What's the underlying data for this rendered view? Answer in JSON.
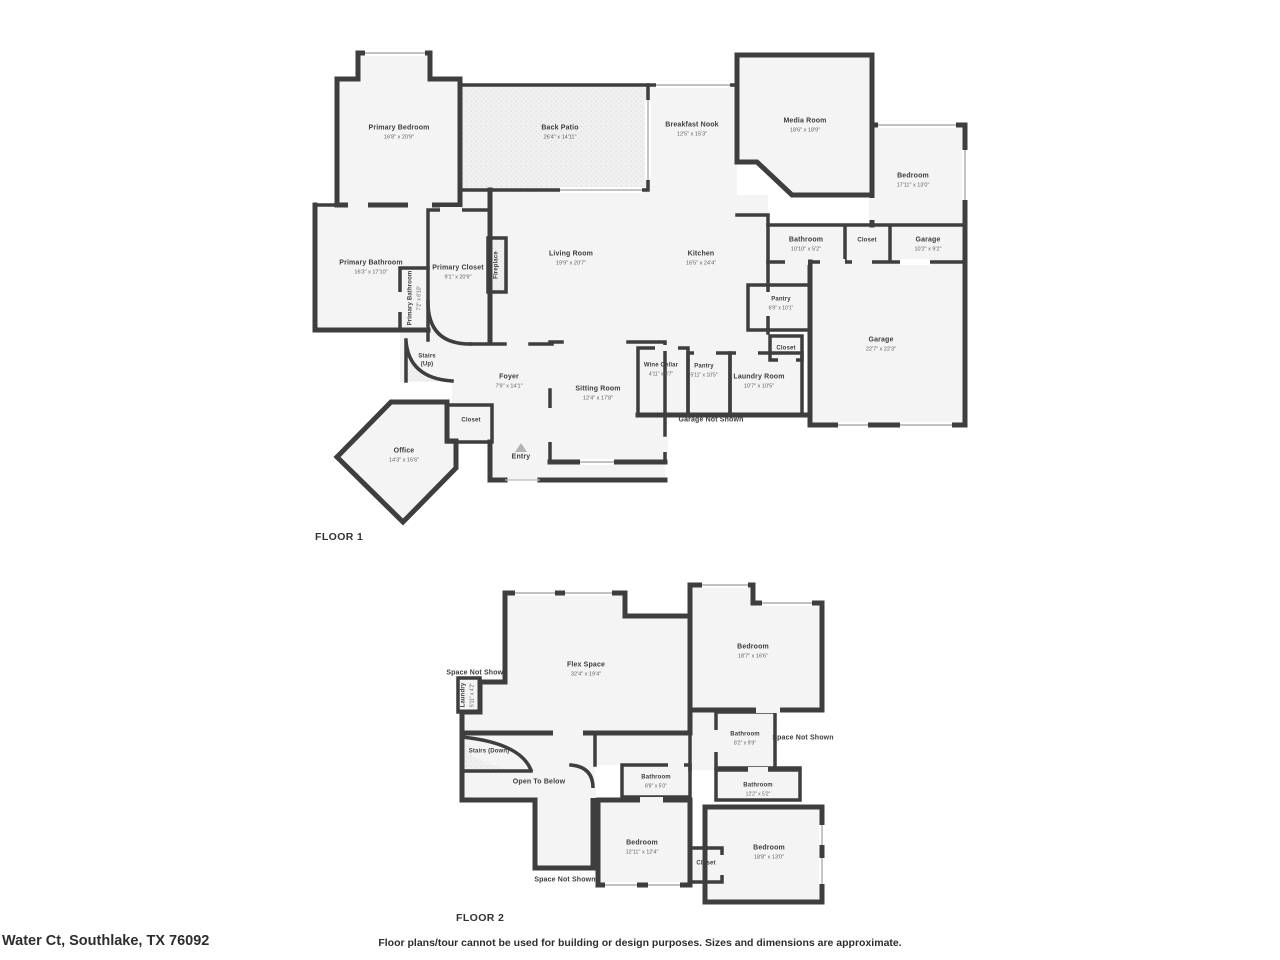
{
  "address": "Water Ct, Southlake, TX 76092",
  "disclaimer": "Floor plans/tour cannot be used for building or design purposes. Sizes and dimensions are approximate.",
  "colors": {
    "wall": "#3e3e3e",
    "room_fill": "#f4f4f4",
    "text": "#3d3d3d"
  },
  "floor1": {
    "title": "FLOOR 1",
    "rooms": {
      "primary_bedroom": {
        "name": "Primary Bedroom",
        "dims": "16'8\" x 20'9\""
      },
      "back_patio": {
        "name": "Back Patio",
        "dims": "26'4\" x 14'11\""
      },
      "breakfast_nook": {
        "name": "Breakfast Nook",
        "dims": "12'5\" x 15'3\""
      },
      "media_room": {
        "name": "Media Room",
        "dims": "18'6\" x 18'9\""
      },
      "bedroom": {
        "name": "Bedroom",
        "dims": "17'11\" x 13'0\""
      },
      "living_room": {
        "name": "Living Room",
        "dims": "19'9\" x 20'7\""
      },
      "kitchen": {
        "name": "Kitchen",
        "dims": "16'5\" x 24'4\""
      },
      "bathroom": {
        "name": "Bathroom",
        "dims": "10'10\" x 5'2\""
      },
      "closet_hall": {
        "name": "Closet"
      },
      "garage_small": {
        "name": "Garage",
        "dims": "10'2\" x 9'2\""
      },
      "primary_bathroom": {
        "name": "Primary Bathroom",
        "dims": "16'3\" x 17'10\""
      },
      "primary_bathroom_2": {
        "name": "Primary Bathroom",
        "dims": "7'2\" x 6'10\""
      },
      "primary_closet": {
        "name": "Primary Closet",
        "dims": "9'1\" x 20'9\""
      },
      "fireplace": {
        "name": "Fireplace"
      },
      "pantry_upper": {
        "name": "Pantry",
        "dims": "6'9\" x 10'1\""
      },
      "garage": {
        "name": "Garage",
        "dims": "22'7\" x 22'3\""
      },
      "wine_cellar": {
        "name": "Wine Cellar",
        "dims": "4'11\" x 8'7\""
      },
      "pantry": {
        "name": "Pantry",
        "dims": "5'11\" x 10'5\""
      },
      "laundry_room": {
        "name": "Laundry Room",
        "dims": "10'7\" x 10'5\""
      },
      "closet_laundry": {
        "name": "Closet"
      },
      "stairs": {
        "name": "Stairs",
        "sub": "(Up)"
      },
      "foyer": {
        "name": "Foyer",
        "dims": "7'9\" x 14'1\""
      },
      "sitting_room": {
        "name": "Sitting Room",
        "dims": "12'4\" x 17'8\""
      },
      "office": {
        "name": "Office",
        "dims": "14'3\" x 16'6\""
      },
      "closet_office": {
        "name": "Closet"
      },
      "entry": {
        "name": "Entry"
      },
      "garage_not_shown": {
        "name": "Garage Not Shown"
      }
    }
  },
  "floor2": {
    "title": "FLOOR 2",
    "rooms": {
      "flex_space": {
        "name": "Flex Space",
        "dims": "32'4\" x 19'4\""
      },
      "bedroom_1": {
        "name": "Bedroom",
        "dims": "18'7\" x 16'6\""
      },
      "space_not_shown_left": {
        "name": "Space Not Shown"
      },
      "laundry": {
        "name": "Laundry",
        "dims": "5'11\" x 4'2\""
      },
      "stairs": {
        "name": "Stairs (Down)"
      },
      "open_to_below": {
        "name": "Open To Below"
      },
      "bathroom_1": {
        "name": "Bathroom",
        "dims": "8'2\" x 9'9\""
      },
      "space_not_shown_right": {
        "name": "Space Not Shown"
      },
      "bathroom_2": {
        "name": "Bathroom",
        "dims": "12'2\" x 5'2\""
      },
      "bathroom_3": {
        "name": "Bathroom",
        "dims": "8'8\" x 5'0\""
      },
      "bedroom_2": {
        "name": "Bedroom",
        "dims": "12'11\" x 12'4\""
      },
      "closet": {
        "name": "Closet"
      },
      "bedroom_3": {
        "name": "Bedroom",
        "dims": "18'8\" x 13'0\""
      },
      "space_not_shown_bottom": {
        "name": "Space Not Shown"
      }
    }
  }
}
